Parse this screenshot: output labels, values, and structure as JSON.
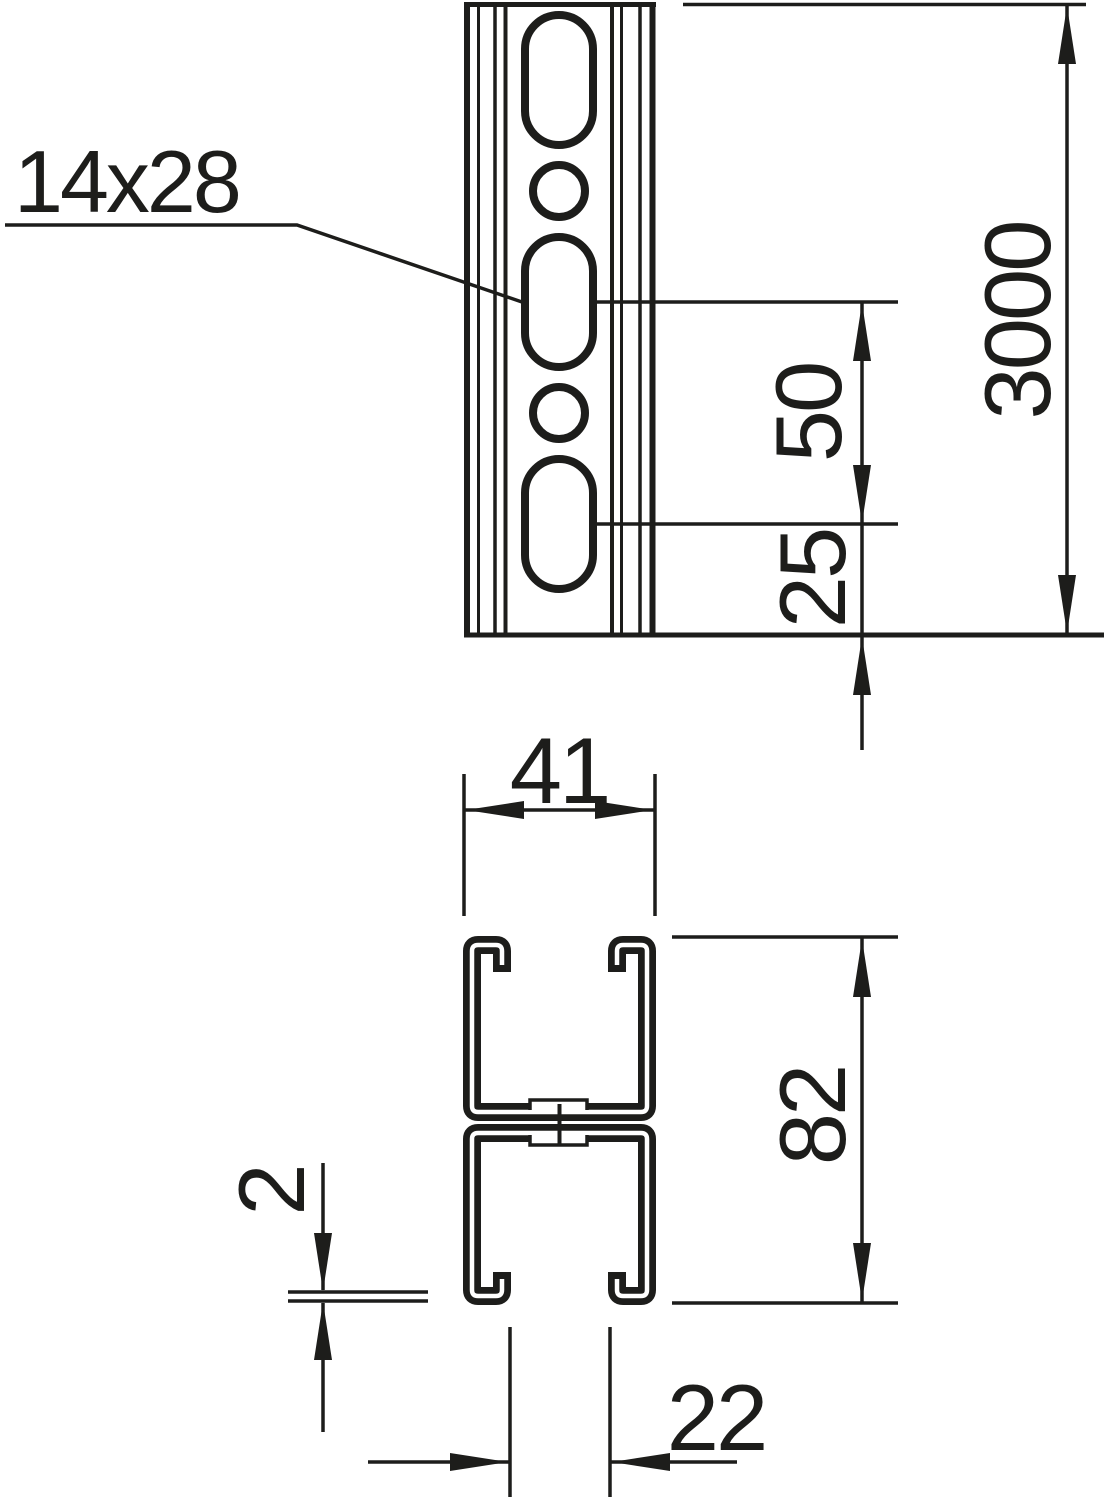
{
  "drawing": {
    "background_color": "#ffffff",
    "line_color": "#1d1d1b",
    "front_view": {
      "slot_label": "14x28",
      "length_dim": "3000",
      "slot_pitch_dim": "50",
      "end_offset_dim": "25"
    },
    "section_view": {
      "width_dim": "41",
      "height_dim": "82",
      "thickness_dim": "2",
      "opening_dim": "22"
    }
  }
}
